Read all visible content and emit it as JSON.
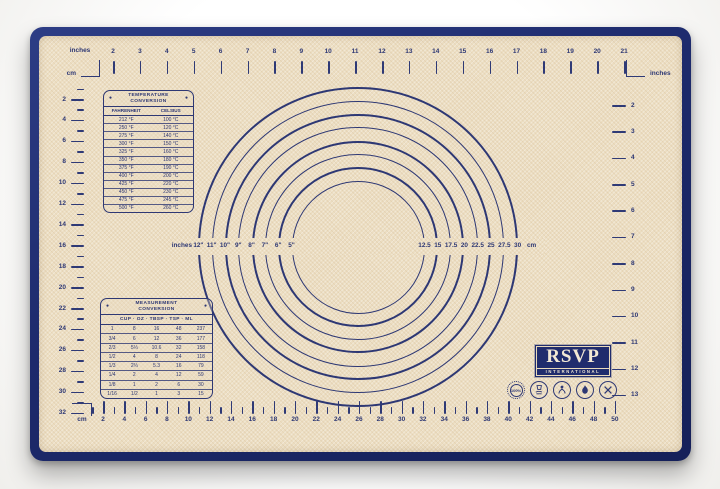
{
  "mat": {
    "border_color": "#1d2a6c",
    "surface_color": "#ecdec2",
    "ink_color": "#2e3874"
  },
  "rulers": {
    "top": {
      "unit_start": "inches",
      "unit_end": "inches",
      "ticks": [
        2,
        3,
        4,
        5,
        6,
        7,
        8,
        9,
        10,
        11,
        12,
        13,
        14,
        15,
        16,
        17,
        18,
        19,
        20,
        21
      ]
    },
    "left": {
      "unit": "cm",
      "ticks": [
        2,
        4,
        6,
        8,
        10,
        12,
        14,
        16,
        18,
        20,
        22,
        24,
        26,
        28,
        30,
        32
      ]
    },
    "right": {
      "unit": "inches",
      "ticks": [
        2,
        3,
        4,
        5,
        6,
        7,
        8,
        9,
        10,
        11,
        12,
        13
      ]
    },
    "bottom": {
      "unit": "cm",
      "ticks": [
        2,
        4,
        6,
        8,
        10,
        12,
        14,
        16,
        18,
        20,
        22,
        24,
        26,
        28,
        30,
        32,
        34,
        36,
        38,
        40,
        42,
        44,
        46,
        48,
        50
      ]
    }
  },
  "circle_gauge": {
    "left_unit_label": "inches",
    "right_unit_label": "cm",
    "diameters_inches": [
      12,
      11,
      10,
      9,
      8,
      7,
      6,
      5
    ],
    "inch_labels": [
      "12\"",
      "11\"",
      "10\"",
      "9\"",
      "8\"",
      "7\"",
      "6\"",
      "5\""
    ],
    "cm_labels": [
      "12.5",
      "15",
      "17.5",
      "20",
      "22.5",
      "25",
      "27.5",
      "30"
    ]
  },
  "temperature_table": {
    "title_line1": "TEMPERATURE",
    "title_line2": "CONVERSION",
    "columns": [
      "FAHRENHEIT",
      "CELSIUS"
    ],
    "rows": [
      [
        "212 °F",
        "100 °C"
      ],
      [
        "250 °F",
        "120 °C"
      ],
      [
        "275 °F",
        "140 °C"
      ],
      [
        "300 °F",
        "150 °C"
      ],
      [
        "325 °F",
        "160 °C"
      ],
      [
        "350 °F",
        "180 °C"
      ],
      [
        "375 °F",
        "190 °C"
      ],
      [
        "400 °F",
        "200 °C"
      ],
      [
        "425 °F",
        "220 °C"
      ],
      [
        "450 °F",
        "230 °C"
      ],
      [
        "475 °F",
        "245 °C"
      ],
      [
        "500 °F",
        "260 °C"
      ]
    ]
  },
  "measurement_table": {
    "title_line1": "MEASUREMENT",
    "title_line2": "CONVERSION",
    "columns": [
      "CUP",
      "OZ",
      "TBSP",
      "TSP",
      "ML"
    ],
    "header_separator": "·",
    "rows": [
      [
        "1",
        "8",
        "16",
        "48",
        "237"
      ],
      [
        "3/4",
        "6",
        "12",
        "36",
        "177"
      ],
      [
        "2/3",
        "5⅓",
        "10.6",
        "32",
        "158"
      ],
      [
        "1/2",
        "4",
        "8",
        "24",
        "118"
      ],
      [
        "1/3",
        "2⅔",
        "5.3",
        "16",
        "79"
      ],
      [
        "1/4",
        "2",
        "4",
        "12",
        "59"
      ],
      [
        "1/8",
        "1",
        "2",
        "6",
        "30"
      ],
      [
        "1/16",
        "1/2",
        "1",
        "3",
        "15"
      ]
    ]
  },
  "branding": {
    "logo_text": "RSVP",
    "logo_subtext": "INTERNATIONAL"
  },
  "badges": [
    {
      "label": "100%"
    }
  ]
}
